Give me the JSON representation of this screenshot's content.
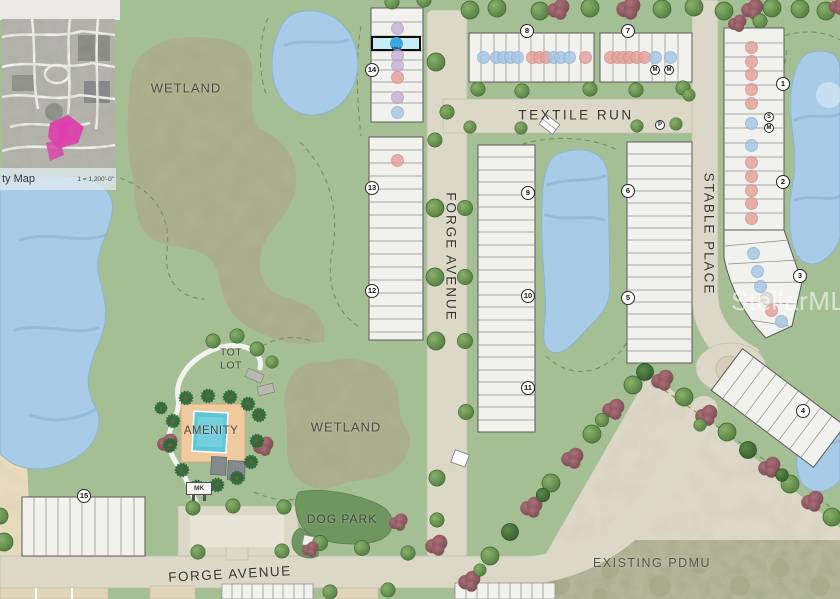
{
  "watermark": "StellarMLS",
  "inset": {
    "caption": "ty Map",
    "scale": "1 = 1,200'-0\""
  },
  "labels": {
    "wetland_top": "WETLAND",
    "wetland_bottom": "WETLAND",
    "textile_run": "TEXTILE RUN",
    "forge_avenue_vertical": "FORGE AVENUE",
    "forge_avenue_bottom": "FORGE AVENUE",
    "stable_place": "STABLE PLACE",
    "tot_lot": "TOT LOT",
    "amenity": "AMENITY",
    "dog_park": "DOG PARK",
    "existing_pdmu": "EXISTING PDMU",
    "mail_kiosk": "MK"
  },
  "selected_lot": {
    "label": "1094"
  },
  "dot_colors": {
    "pink": "#e5a19a",
    "blue": "#a4c6e6",
    "purple": "#c6b2d8",
    "gray": "#dadad4"
  },
  "block_markers": [
    {
      "label": "14",
      "x": 372,
      "y": 70
    },
    {
      "label": "13",
      "x": 372,
      "y": 188
    },
    {
      "label": "12",
      "x": 372,
      "y": 291
    },
    {
      "label": "8",
      "x": 527,
      "y": 31
    },
    {
      "label": "7",
      "x": 628,
      "y": 31
    },
    {
      "label": "9",
      "x": 528,
      "y": 193
    },
    {
      "label": "10",
      "x": 528,
      "y": 296
    },
    {
      "label": "11",
      "x": 528,
      "y": 388
    },
    {
      "label": "6",
      "x": 628,
      "y": 191
    },
    {
      "label": "5",
      "x": 628,
      "y": 298
    },
    {
      "label": "1",
      "x": 783,
      "y": 84
    },
    {
      "label": "2",
      "x": 783,
      "y": 182
    },
    {
      "label": "3",
      "x": 800,
      "y": 276
    },
    {
      "label": "4",
      "x": 803,
      "y": 411
    },
    {
      "label": "15",
      "x": 84,
      "y": 496
    }
  ],
  "small_markers": [
    {
      "label": "M",
      "x": 655,
      "y": 70
    },
    {
      "label": "M",
      "x": 669,
      "y": 70
    },
    {
      "label": "P",
      "x": 660,
      "y": 125
    },
    {
      "label": "S",
      "x": 769,
      "y": 117
    },
    {
      "label": "M",
      "x": 769,
      "y": 128
    }
  ],
  "unit_dots": [
    {
      "color": "purple",
      "x": 397,
      "y": 28
    },
    {
      "color": "purple",
      "x": 397,
      "y": 55
    },
    {
      "color": "purple",
      "x": 397,
      "y": 65
    },
    {
      "color": "pink",
      "x": 397,
      "y": 77
    },
    {
      "color": "purple",
      "x": 397,
      "y": 97
    },
    {
      "color": "blue",
      "x": 397,
      "y": 112
    },
    {
      "color": "pink",
      "x": 397,
      "y": 160
    },
    {
      "color": "blue",
      "x": 483,
      "y": 57
    },
    {
      "color": "blue",
      "x": 496,
      "y": 57
    },
    {
      "color": "blue",
      "x": 503,
      "y": 57
    },
    {
      "color": "blue",
      "x": 510,
      "y": 57
    },
    {
      "color": "blue",
      "x": 517,
      "y": 57
    },
    {
      "color": "pink",
      "x": 532,
      "y": 57
    },
    {
      "color": "pink",
      "x": 539,
      "y": 57
    },
    {
      "color": "pink",
      "x": 546,
      "y": 57
    },
    {
      "color": "blue",
      "x": 553,
      "y": 57
    },
    {
      "color": "blue",
      "x": 560,
      "y": 57
    },
    {
      "color": "blue",
      "x": 569,
      "y": 57
    },
    {
      "color": "pink",
      "x": 585,
      "y": 57
    },
    {
      "color": "pink",
      "x": 610,
      "y": 57
    },
    {
      "color": "pink",
      "x": 617,
      "y": 57
    },
    {
      "color": "pink",
      "x": 623,
      "y": 57
    },
    {
      "color": "pink",
      "x": 629,
      "y": 57
    },
    {
      "color": "pink",
      "x": 636,
      "y": 57
    },
    {
      "color": "pink",
      "x": 644,
      "y": 57
    },
    {
      "color": "blue",
      "x": 655,
      "y": 57
    },
    {
      "color": "blue",
      "x": 670,
      "y": 57
    },
    {
      "color": "pink",
      "x": 751,
      "y": 47
    },
    {
      "color": "pink",
      "x": 751,
      "y": 61
    },
    {
      "color": "pink",
      "x": 751,
      "y": 74
    },
    {
      "color": "pink",
      "x": 751,
      "y": 89
    },
    {
      "color": "pink",
      "x": 751,
      "y": 103
    },
    {
      "color": "blue",
      "x": 751,
      "y": 123
    },
    {
      "color": "blue",
      "x": 751,
      "y": 145
    },
    {
      "color": "pink",
      "x": 751,
      "y": 162
    },
    {
      "color": "pink",
      "x": 751,
      "y": 176
    },
    {
      "color": "pink",
      "x": 751,
      "y": 190
    },
    {
      "color": "pink",
      "x": 751,
      "y": 203
    },
    {
      "color": "pink",
      "x": 751,
      "y": 218
    },
    {
      "color": "blue",
      "x": 753,
      "y": 253
    },
    {
      "color": "blue",
      "x": 757,
      "y": 271
    },
    {
      "color": "blue",
      "x": 760,
      "y": 286
    },
    {
      "color": "gray",
      "x": 766,
      "y": 298
    },
    {
      "color": "pink",
      "x": 771,
      "y": 310
    },
    {
      "color": "blue",
      "x": 781,
      "y": 321
    }
  ]
}
